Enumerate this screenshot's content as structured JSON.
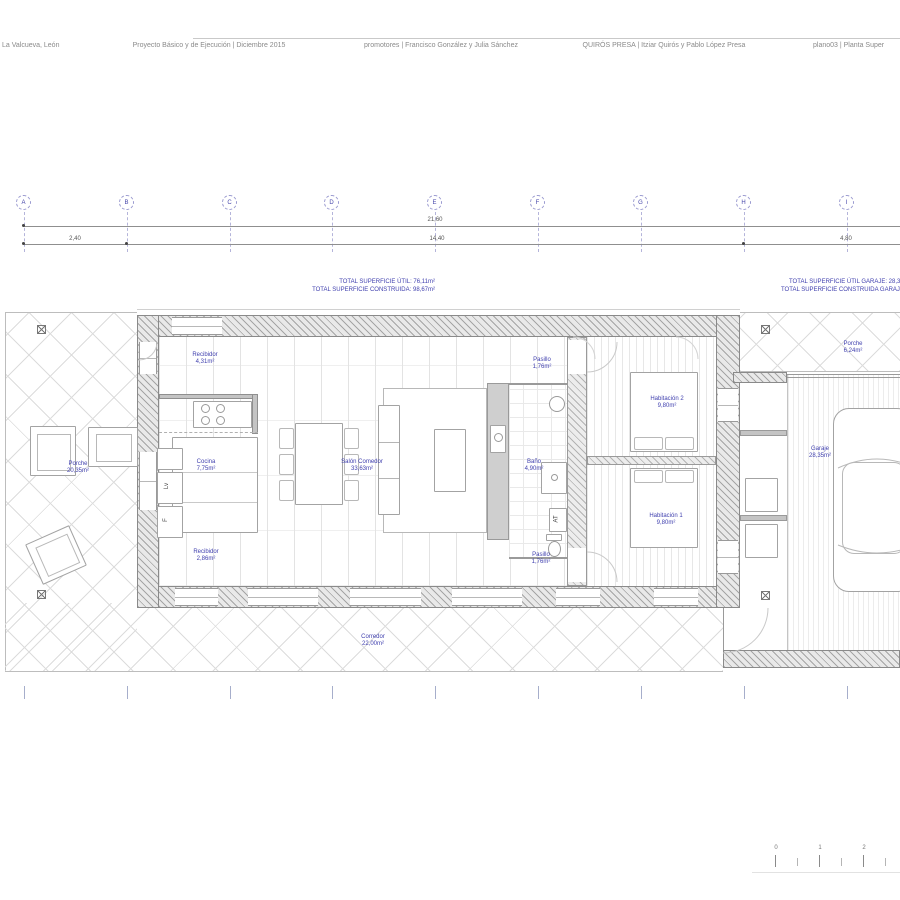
{
  "header": {
    "location": "La Valcueva, León",
    "project": "Proyecto Básico y de Ejecución | Diciembre 2015",
    "promoters": "promotores | Francisco González y Julia Sánchez",
    "architects": "QUIRÓS PRESA | Itziar Quirós y Pablo López Presa",
    "sheet": "plano03 | Planta Super"
  },
  "grid": {
    "bubbles": [
      "A",
      "B",
      "C",
      "D",
      "E",
      "F",
      "G",
      "H",
      "I"
    ],
    "dimensions": {
      "total": "21,60",
      "left": "2,40",
      "center": "14,40",
      "right": "4,80"
    }
  },
  "totals": {
    "house_util": "TOTAL SUPERFICIE ÚTIL: 76,11m²",
    "house_construida": "TOTAL SUPERFICIE CONSTRUIDA: 98,67m²",
    "garage_util": "TOTAL SUPERFICIE ÚTIL GARAJE: 28,35m²",
    "garage_construida": "TOTAL SUPERFICIE CONSTRUIDA GARAJE: 33,"
  },
  "rooms": [
    {
      "name": "Recibidor",
      "area": "4,31m²"
    },
    {
      "name": "Pasillo",
      "area": "1,76m²"
    },
    {
      "name": "Habitación 2",
      "area": "9,80m²"
    },
    {
      "name": "Porche",
      "area": "6,24m²"
    },
    {
      "name": "Porche",
      "area": "20,35m²"
    },
    {
      "name": "Cocina",
      "area": "7,75m²"
    },
    {
      "name": "Salón Comedor",
      "area": "33,63m²"
    },
    {
      "name": "Baño",
      "area": "4,90m²"
    },
    {
      "name": "Garaje",
      "area": "28,35m²"
    },
    {
      "name": "Recibidor",
      "area": "2,86m²"
    },
    {
      "name": "Pasillo",
      "area": "1,76m²"
    },
    {
      "name": "Habitación 1",
      "area": "9,80m²"
    },
    {
      "name": "Corredor",
      "area": "22,00m²"
    }
  ],
  "labels": {
    "lv": "Lv",
    "f": "F",
    "at": "AT"
  },
  "scalebar": {
    "ticks": [
      "0",
      "1",
      "2"
    ]
  }
}
